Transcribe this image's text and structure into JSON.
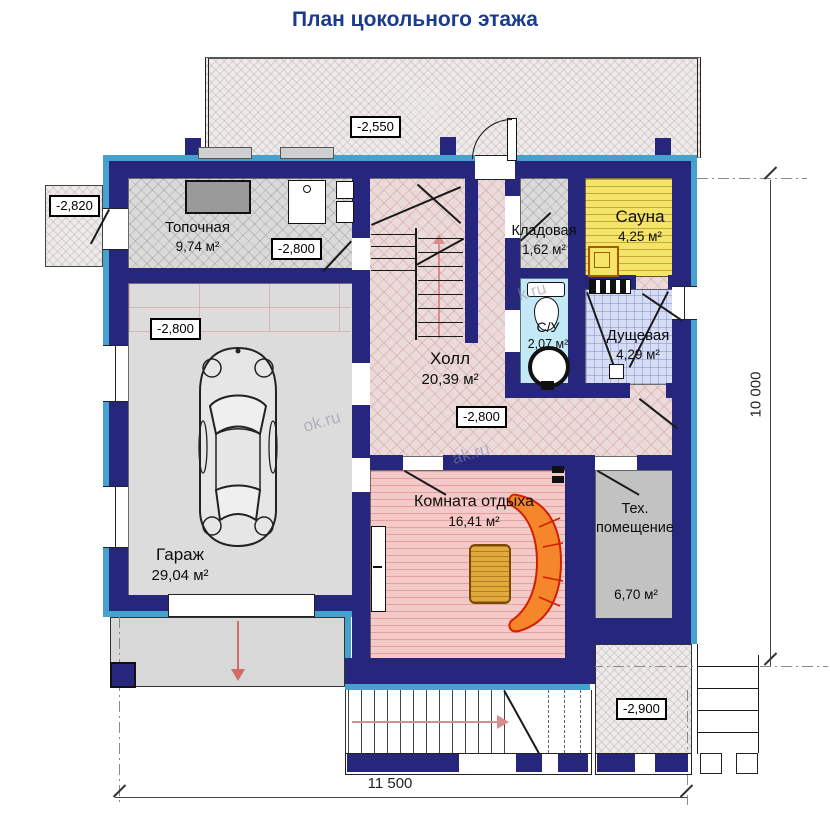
{
  "title": "План цокольного этажа",
  "rooms": {
    "boiler": {
      "name": "Топочная",
      "area": "9,74 м²"
    },
    "garage": {
      "name": "Гараж",
      "area": "29,04 м²"
    },
    "hall": {
      "name": "Холл",
      "area": "20,39 м²"
    },
    "storage": {
      "name": "Кладовая",
      "area": "1,62 м²"
    },
    "sauna": {
      "name": "Сауна",
      "area": "4,25 м²"
    },
    "wc": {
      "name": "С/У",
      "area": "2,07 м²"
    },
    "shower": {
      "name": "Дущевая",
      "area": "4,29 м²"
    },
    "lounge": {
      "name": "Комната отдыха",
      "area": "16,41 м²"
    },
    "tech": {
      "name_line1": "Тех.",
      "name_line2": "помещение",
      "area": "6,70 м²"
    }
  },
  "elevations": {
    "terrace": "-2,550",
    "side_entry": "-2,820",
    "boiler": "-2,800",
    "garage": "-2,800",
    "hall": "-2,800",
    "porch": "-2,900"
  },
  "dimensions": {
    "width": "11 500",
    "height": "10 000"
  },
  "watermarks": {
    "w1": "ok.ru",
    "w2": "k.ru",
    "w3": "ak.ru"
  },
  "colors": {
    "wall": "#26267d",
    "band": "#45a2cc",
    "sauna": "#f4e568",
    "lounge": "#f4cac8",
    "accent_red": "#d46a6a",
    "title": "#1b3c8e"
  }
}
